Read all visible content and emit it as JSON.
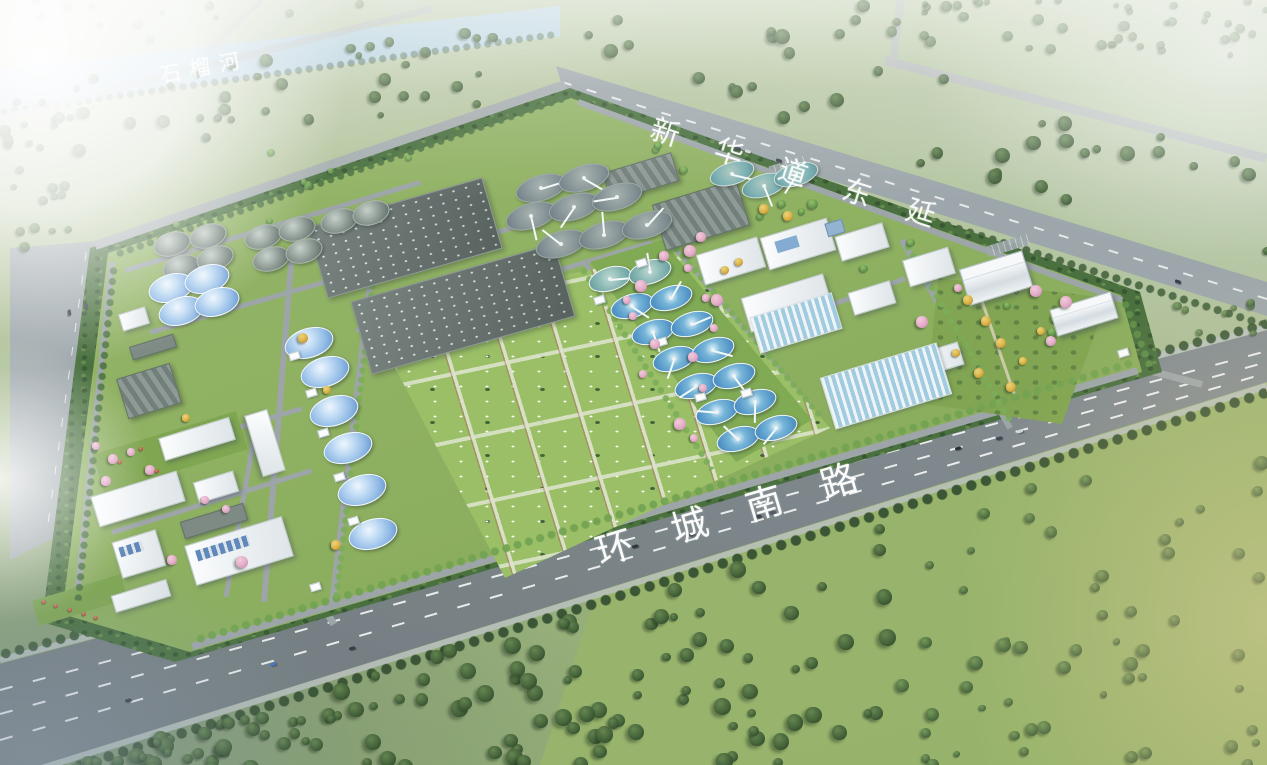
{
  "scene": {
    "type": "aerial-architectural-rendering",
    "subject": "wastewater treatment plant campus with surrounding roads, river and woodland"
  },
  "labels": {
    "river": "石榴河",
    "north_road": "新华道东延",
    "south_road": "环城南路"
  },
  "palette": {
    "haze_white": "#ffffff",
    "field_green": "#9db47f",
    "meadow_green": "#94b164",
    "forest_green": "#3c5e32",
    "campus_lawn": "#88ac59",
    "bright_lawn": "#97bd61",
    "tree_band": "#426b37",
    "road_asphalt": "#747e82",
    "road_light": "#9aa4a8",
    "river_water": "#a9cade",
    "clarifier_water": "#4e93c6",
    "clarifier_teal": "#6fa9ad",
    "dome_blue": "#8fb9e6",
    "tank_gray": "#78867f",
    "slab_gray": "#5d6965",
    "building_white": "#f4f6f8",
    "blossom_pink": "#e2a8c4",
    "autumn_yellow": "#d8ae3c",
    "label_white": "#ffffff"
  },
  "facility_legend": {
    "blue_round_tanks": "domed digesters and clarifiers with blue water",
    "gray_round_tanks": "covered gray process tanks",
    "dark_slabs": "covered aeration basins with vent dots",
    "green_field": "landscaped plots with small vent covers",
    "striped_basins": "filter lanes",
    "white_blocks": "plant buildings and offices"
  }
}
